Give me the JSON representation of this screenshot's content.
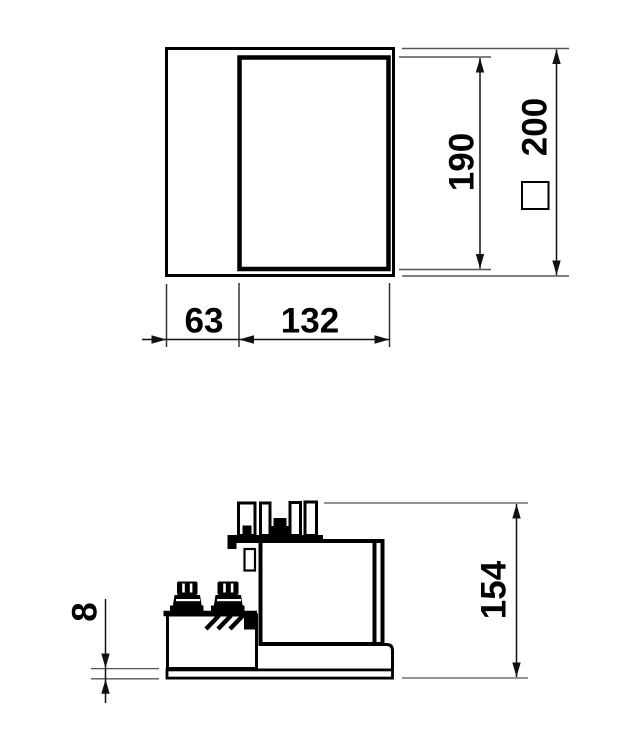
{
  "colors": {
    "background": "#ffffff",
    "object_line": "#000000",
    "dimension_line": "#111111",
    "extension_line": "#555555",
    "text": "#000000"
  },
  "top_view": {
    "dim_width_left": "63",
    "dim_width_right": "132",
    "dim_height_inner": "190",
    "dim_height_outer": "200",
    "dim_height_outer_symbol": "square"
  },
  "side_view": {
    "dim_overall_height": "154",
    "dim_base_plate_thickness": "8"
  }
}
